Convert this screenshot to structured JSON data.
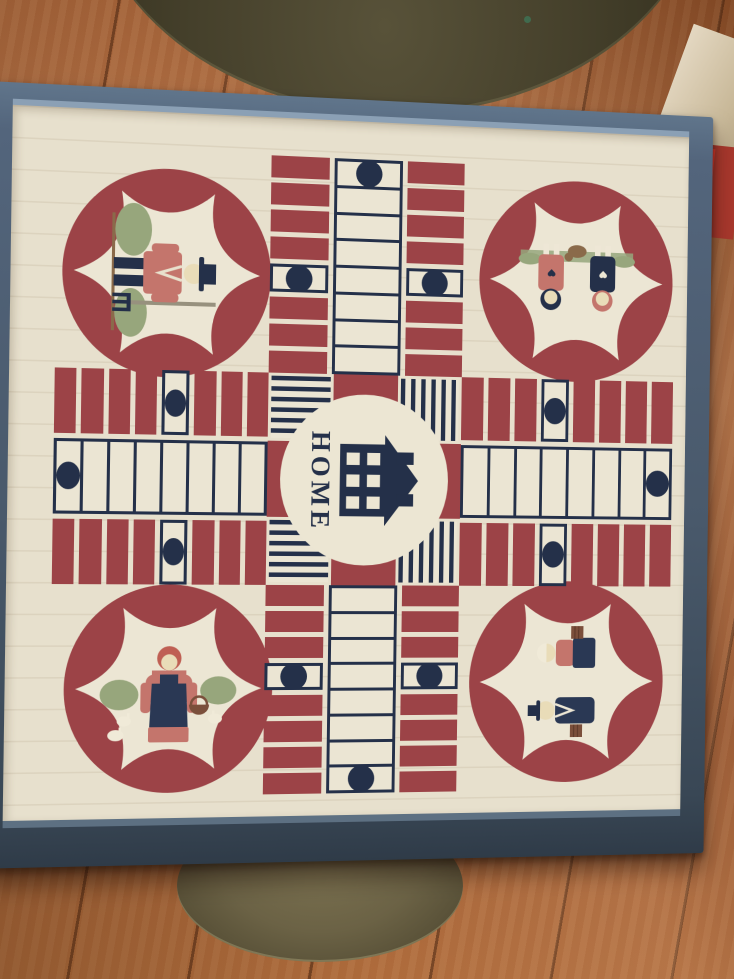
{
  "scene": {
    "setting": "hand-painted wooden parcheesi game board in a blue-gray frame, resting on a round brass table over a wood plank floor",
    "objects": {
      "table": "brass-table",
      "floor": "wood-plank-floor",
      "board": "folk-art-parcheesi-board"
    },
    "palette": {
      "board_cream": "#e7e0cd",
      "track_maroon": "#9c4347",
      "navy": "#243049",
      "frame_blue": "#53657c",
      "frame_highlight": "#8ba0b5",
      "floor_wood": "#a86036",
      "brass": "#45402b",
      "figure_salmon": "#c4756c",
      "figure_green": "#97a67c",
      "figure_terracotta": "#bf5f53",
      "basket_brown": "#7b4f3b"
    }
  },
  "board": {
    "center_label": "HOME",
    "center_icon": "house-icon",
    "track": {
      "lanes_per_arm": 3,
      "cells_per_lane": 8,
      "side_dot_from_outer": 5,
      "mid_dot_from_outer": 1
    },
    "arms": [
      {
        "id": "top",
        "reverse": false
      },
      {
        "id": "bottom",
        "reverse": true
      },
      {
        "id": "left",
        "reverse": false
      },
      {
        "id": "right",
        "reverse": true
      }
    ],
    "stripe_squares": [
      {
        "pos": "tl",
        "direction": "horizontal"
      },
      {
        "pos": "tr",
        "direction": "vertical"
      },
      {
        "pos": "bl",
        "direction": "horizontal"
      },
      {
        "pos": "br",
        "direction": "vertical"
      }
    ],
    "corners": [
      {
        "id": "tl",
        "figure": "farmer-with-pitchfork",
        "rotation_deg": 90
      },
      {
        "id": "tr",
        "figure": "two-children-with-puppy",
        "rotation_deg": 180
      },
      {
        "id": "bl",
        "figure": "woman-with-basket-and-geese",
        "rotation_deg": 0
      },
      {
        "id": "br",
        "figure": "couple-with-baskets",
        "rotation_deg": -90
      }
    ]
  }
}
